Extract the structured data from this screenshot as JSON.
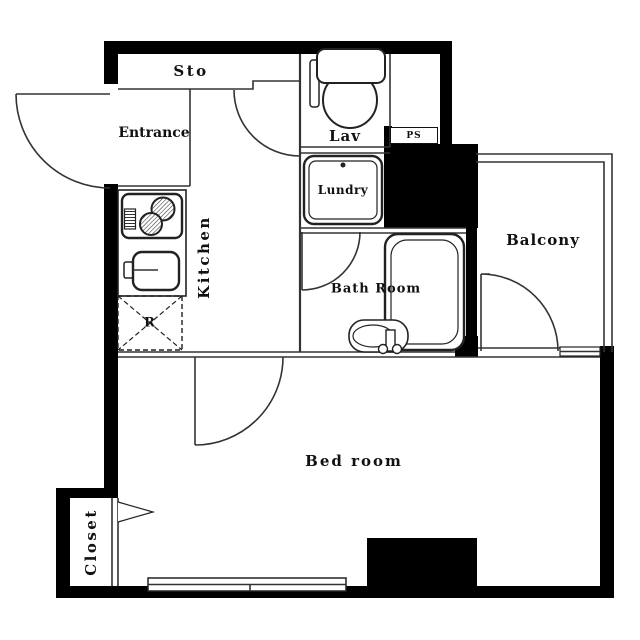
{
  "colors": {
    "wall": "#000000",
    "line": "#333333",
    "background": "#ffffff",
    "text": "#111111"
  },
  "rooms": {
    "sto": {
      "label": "Sto"
    },
    "entrance": {
      "label": "Entrance"
    },
    "lav": {
      "label": "Lav"
    },
    "ps": {
      "label": "PS"
    },
    "laundry": {
      "label": "Lundry"
    },
    "kitchen": {
      "label": "Kitchen"
    },
    "bathroom": {
      "label": "Bath Room"
    },
    "balcony": {
      "label": "Balcony"
    },
    "refrigerator": {
      "label": "R"
    },
    "bedroom": {
      "label": "Bed room"
    },
    "closet": {
      "label": "Closet"
    }
  }
}
